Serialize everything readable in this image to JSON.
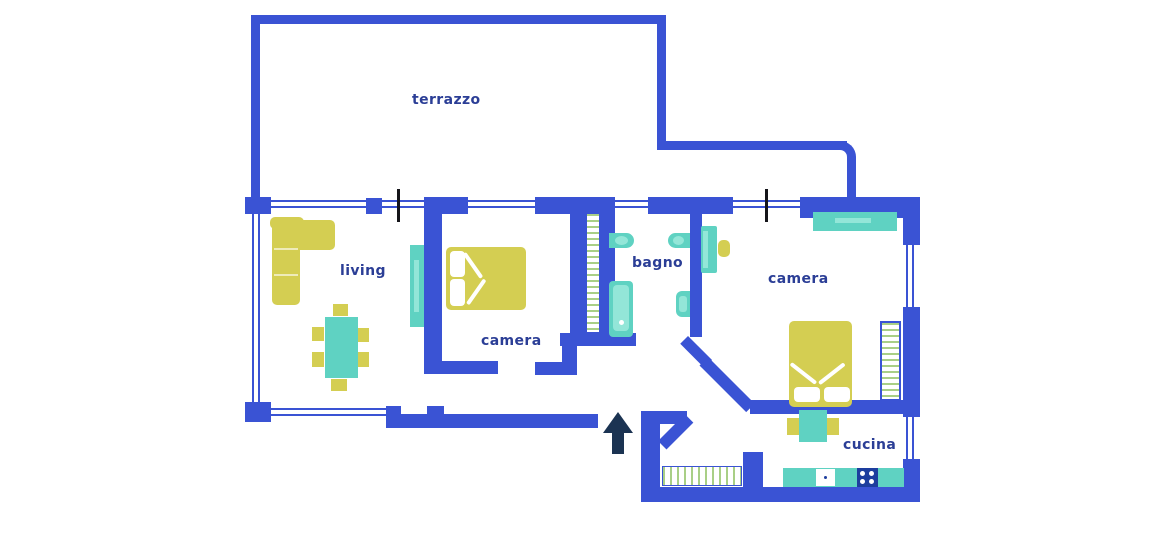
{
  "title": "apartment floor plan",
  "rooms": [
    {
      "id": "terrazzo",
      "label": "terrazzo"
    },
    {
      "id": "living",
      "label": "living"
    },
    {
      "id": "camera-1",
      "label": "camera"
    },
    {
      "id": "bagno",
      "label": "bagno"
    },
    {
      "id": "camera-2",
      "label": "camera"
    },
    {
      "id": "cucina",
      "label": "cucina"
    }
  ],
  "entrance": {
    "icon": "entrance-arrow",
    "direction": "up"
  },
  "palette": {
    "wall_blue": "#3a53d4",
    "label_indigo": "#2b3e96",
    "arrow_navy": "#1b3352",
    "stove_navy": "#1d3e9e",
    "furniture_yellow": "#d4ce52",
    "furniture_teal": "#5fd2c2",
    "hatch_green": "#a9cf86",
    "background": "#ffffff"
  },
  "furniture": {
    "living": [
      "corner-sofa",
      "dining-table",
      "dining-chairs"
    ],
    "camera-1": [
      "wardrobe",
      "double-bed"
    ],
    "bagno": [
      "washbasin",
      "toilet",
      "bathtub",
      "bidet"
    ],
    "camera-2": [
      "wardrobe",
      "desk",
      "desk-chair",
      "double-bed",
      "radiator"
    ],
    "cucina": [
      "kitchen-table",
      "chairs",
      "counter",
      "kitchen-sink",
      "stove"
    ],
    "ingresso": [
      "radiator",
      "closet"
    ]
  }
}
